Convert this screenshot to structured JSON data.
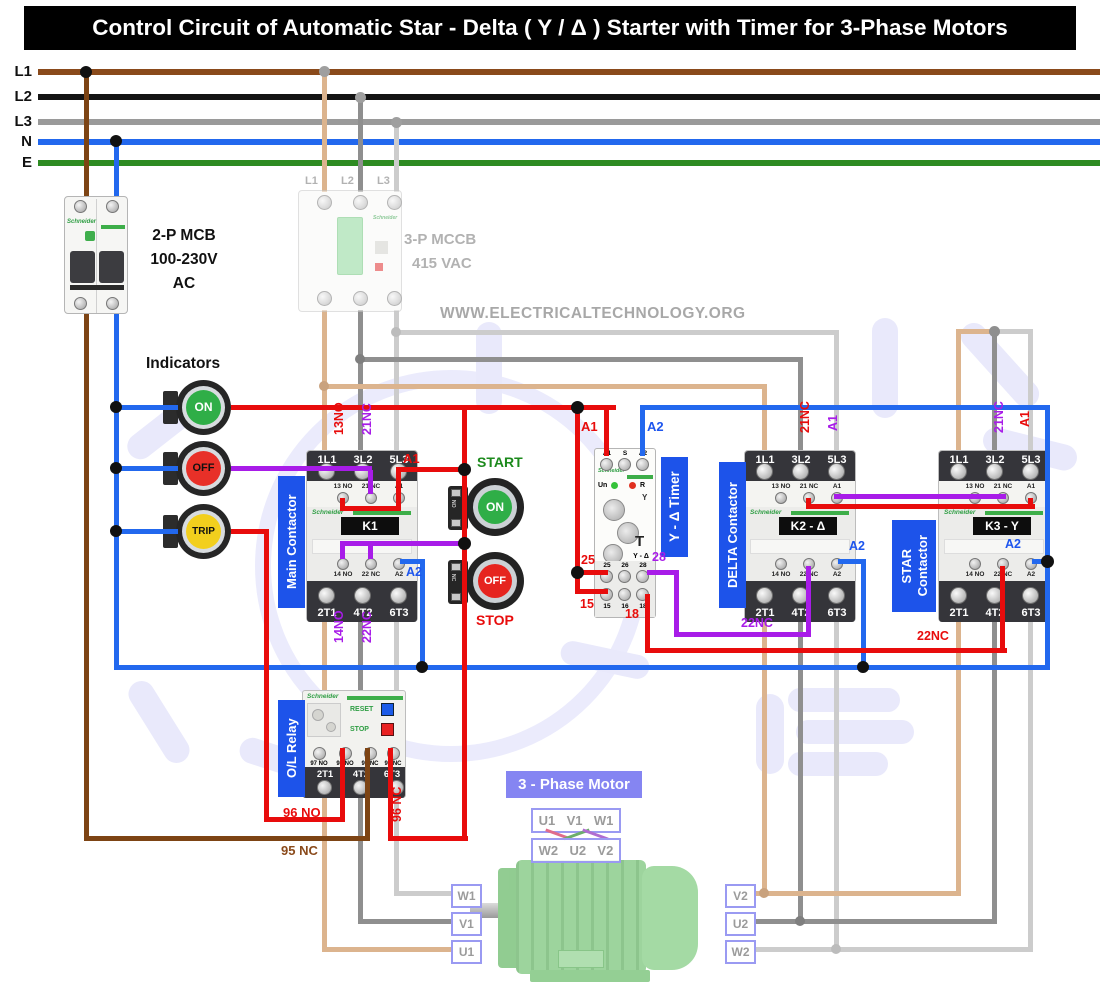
{
  "title": "Control Circuit of Automatic Star - Delta ( Y / Δ ) Starter with Timer for 3-Phase Motors",
  "site": "WWW.ELECTRICALTECHNOLOGY.ORG",
  "rails": {
    "l1": "L1",
    "l2": "L2",
    "l3": "L3",
    "n": "N",
    "e": "E"
  },
  "mcb": {
    "brand": "Schneider",
    "lines": [
      "2-P MCB",
      "100-230V",
      "AC"
    ]
  },
  "mccb": {
    "brand": "Schneider",
    "terminals": [
      "L1",
      "L2",
      "L3"
    ],
    "lines": [
      "3-P MCCB",
      "415 VAC"
    ]
  },
  "indicators": {
    "heading": "Indicators",
    "on": "ON",
    "off": "OFF",
    "trip": "TRIP"
  },
  "buttons": {
    "start_caption": "START",
    "start_label": "ON",
    "start_type": "NO",
    "stop_caption": "STOP",
    "stop_label": "OFF",
    "stop_type": "NC"
  },
  "tags": {
    "main": "Main Contactor",
    "delta": "DELTA Contactor",
    "star_line1": "STAR",
    "star_line2": "Contactor",
    "timer": "Y - Δ Timer",
    "ol": "O/L Relay"
  },
  "k1": {
    "brand": "Schneider",
    "plate": "K1",
    "top": [
      "1L1",
      "3L2",
      "5L3"
    ],
    "aux_top": [
      "13 NO",
      "21 NC",
      "A1"
    ],
    "aux_bot": [
      "14 NO",
      "22 NC",
      "A2"
    ],
    "bot": [
      "2T1",
      "4T2",
      "6T3"
    ]
  },
  "k2": {
    "brand": "Schneider",
    "plate": "K2 - Δ",
    "top": [
      "1L1",
      "3L2",
      "5L3"
    ],
    "aux_top": [
      "13 NO",
      "21 NC",
      "A1"
    ],
    "aux_bot": [
      "14 NO",
      "22 NC",
      "A2"
    ],
    "bot": [
      "2T1",
      "4T2",
      "6T3"
    ]
  },
  "k3": {
    "brand": "Schneider",
    "plate": "K3 - Y",
    "top": [
      "1L1",
      "3L2",
      "5L3"
    ],
    "aux_top": [
      "13 NO",
      "21 NC",
      "A1"
    ],
    "aux_bot": [
      "14 NO",
      "22 NC",
      "A2"
    ],
    "bot": [
      "2T1",
      "4T2",
      "6T3"
    ]
  },
  "timer": {
    "brand": "Schneider",
    "top": [
      "A1",
      "S",
      "A2"
    ],
    "un": "Un",
    "r": "R",
    "y": "Y",
    "t": "T",
    "yd": "Y - Δ",
    "mid": [
      "25",
      "26",
      "28"
    ],
    "bot": [
      "15",
      "16",
      "18"
    ]
  },
  "ol": {
    "brand": "Schneider",
    "reset": "RESET",
    "stop": "STOP",
    "contacts": [
      "97 NO",
      "98 NO",
      "95 NC",
      "96 NC"
    ],
    "bot": [
      "2T1",
      "4T2",
      "6T3"
    ]
  },
  "wire_labels": {
    "k1_13no": "13NO",
    "k1_21nc": "21NC",
    "k1_a1": "A1",
    "k1_14no": "14NO",
    "k1_22nc": "22NC",
    "k1_a2": "A2",
    "t_a1": "A1",
    "t_a2": "A2",
    "t_25": "25",
    "t_15": "15",
    "t_28": "28",
    "t_18": "18",
    "d_21nc": "21NC",
    "d_a1": "A1",
    "d_a2": "A2",
    "d_22nc": "22NC",
    "s_21nc": "21NC",
    "s_a1": "A1",
    "s_a2": "A2",
    "s_22nc": "22NC",
    "ol_96no": "96 NO",
    "ol_95nc": "95 NC",
    "ol_96nc": "96 NC"
  },
  "motor": {
    "caption": "3 - Phase Motor",
    "link_top": [
      "U1",
      "V1",
      "W1"
    ],
    "link_bot": [
      "W2",
      "U2",
      "V2"
    ],
    "left": [
      "W1",
      "V1",
      "U1"
    ],
    "right": [
      "V2",
      "U2",
      "W2"
    ]
  },
  "colors": {
    "phase_l1": "#8a4a1b",
    "phase_l2": "#141414",
    "phase_l3": "#9a9a9a",
    "neutral": "#2268ee",
    "earth": "#2e8b22",
    "control_red": "#e80c0c",
    "control_purple": "#a81ce8",
    "wire_tan": "#dcb48e",
    "wire_gray": "#8f8f8f",
    "wire_lightgray": "#cccccc",
    "tag_blue": "#1d53ea",
    "on_green": "#2fae47",
    "off_red": "#e6241f",
    "trip_yellow": "#f2cf1d"
  }
}
